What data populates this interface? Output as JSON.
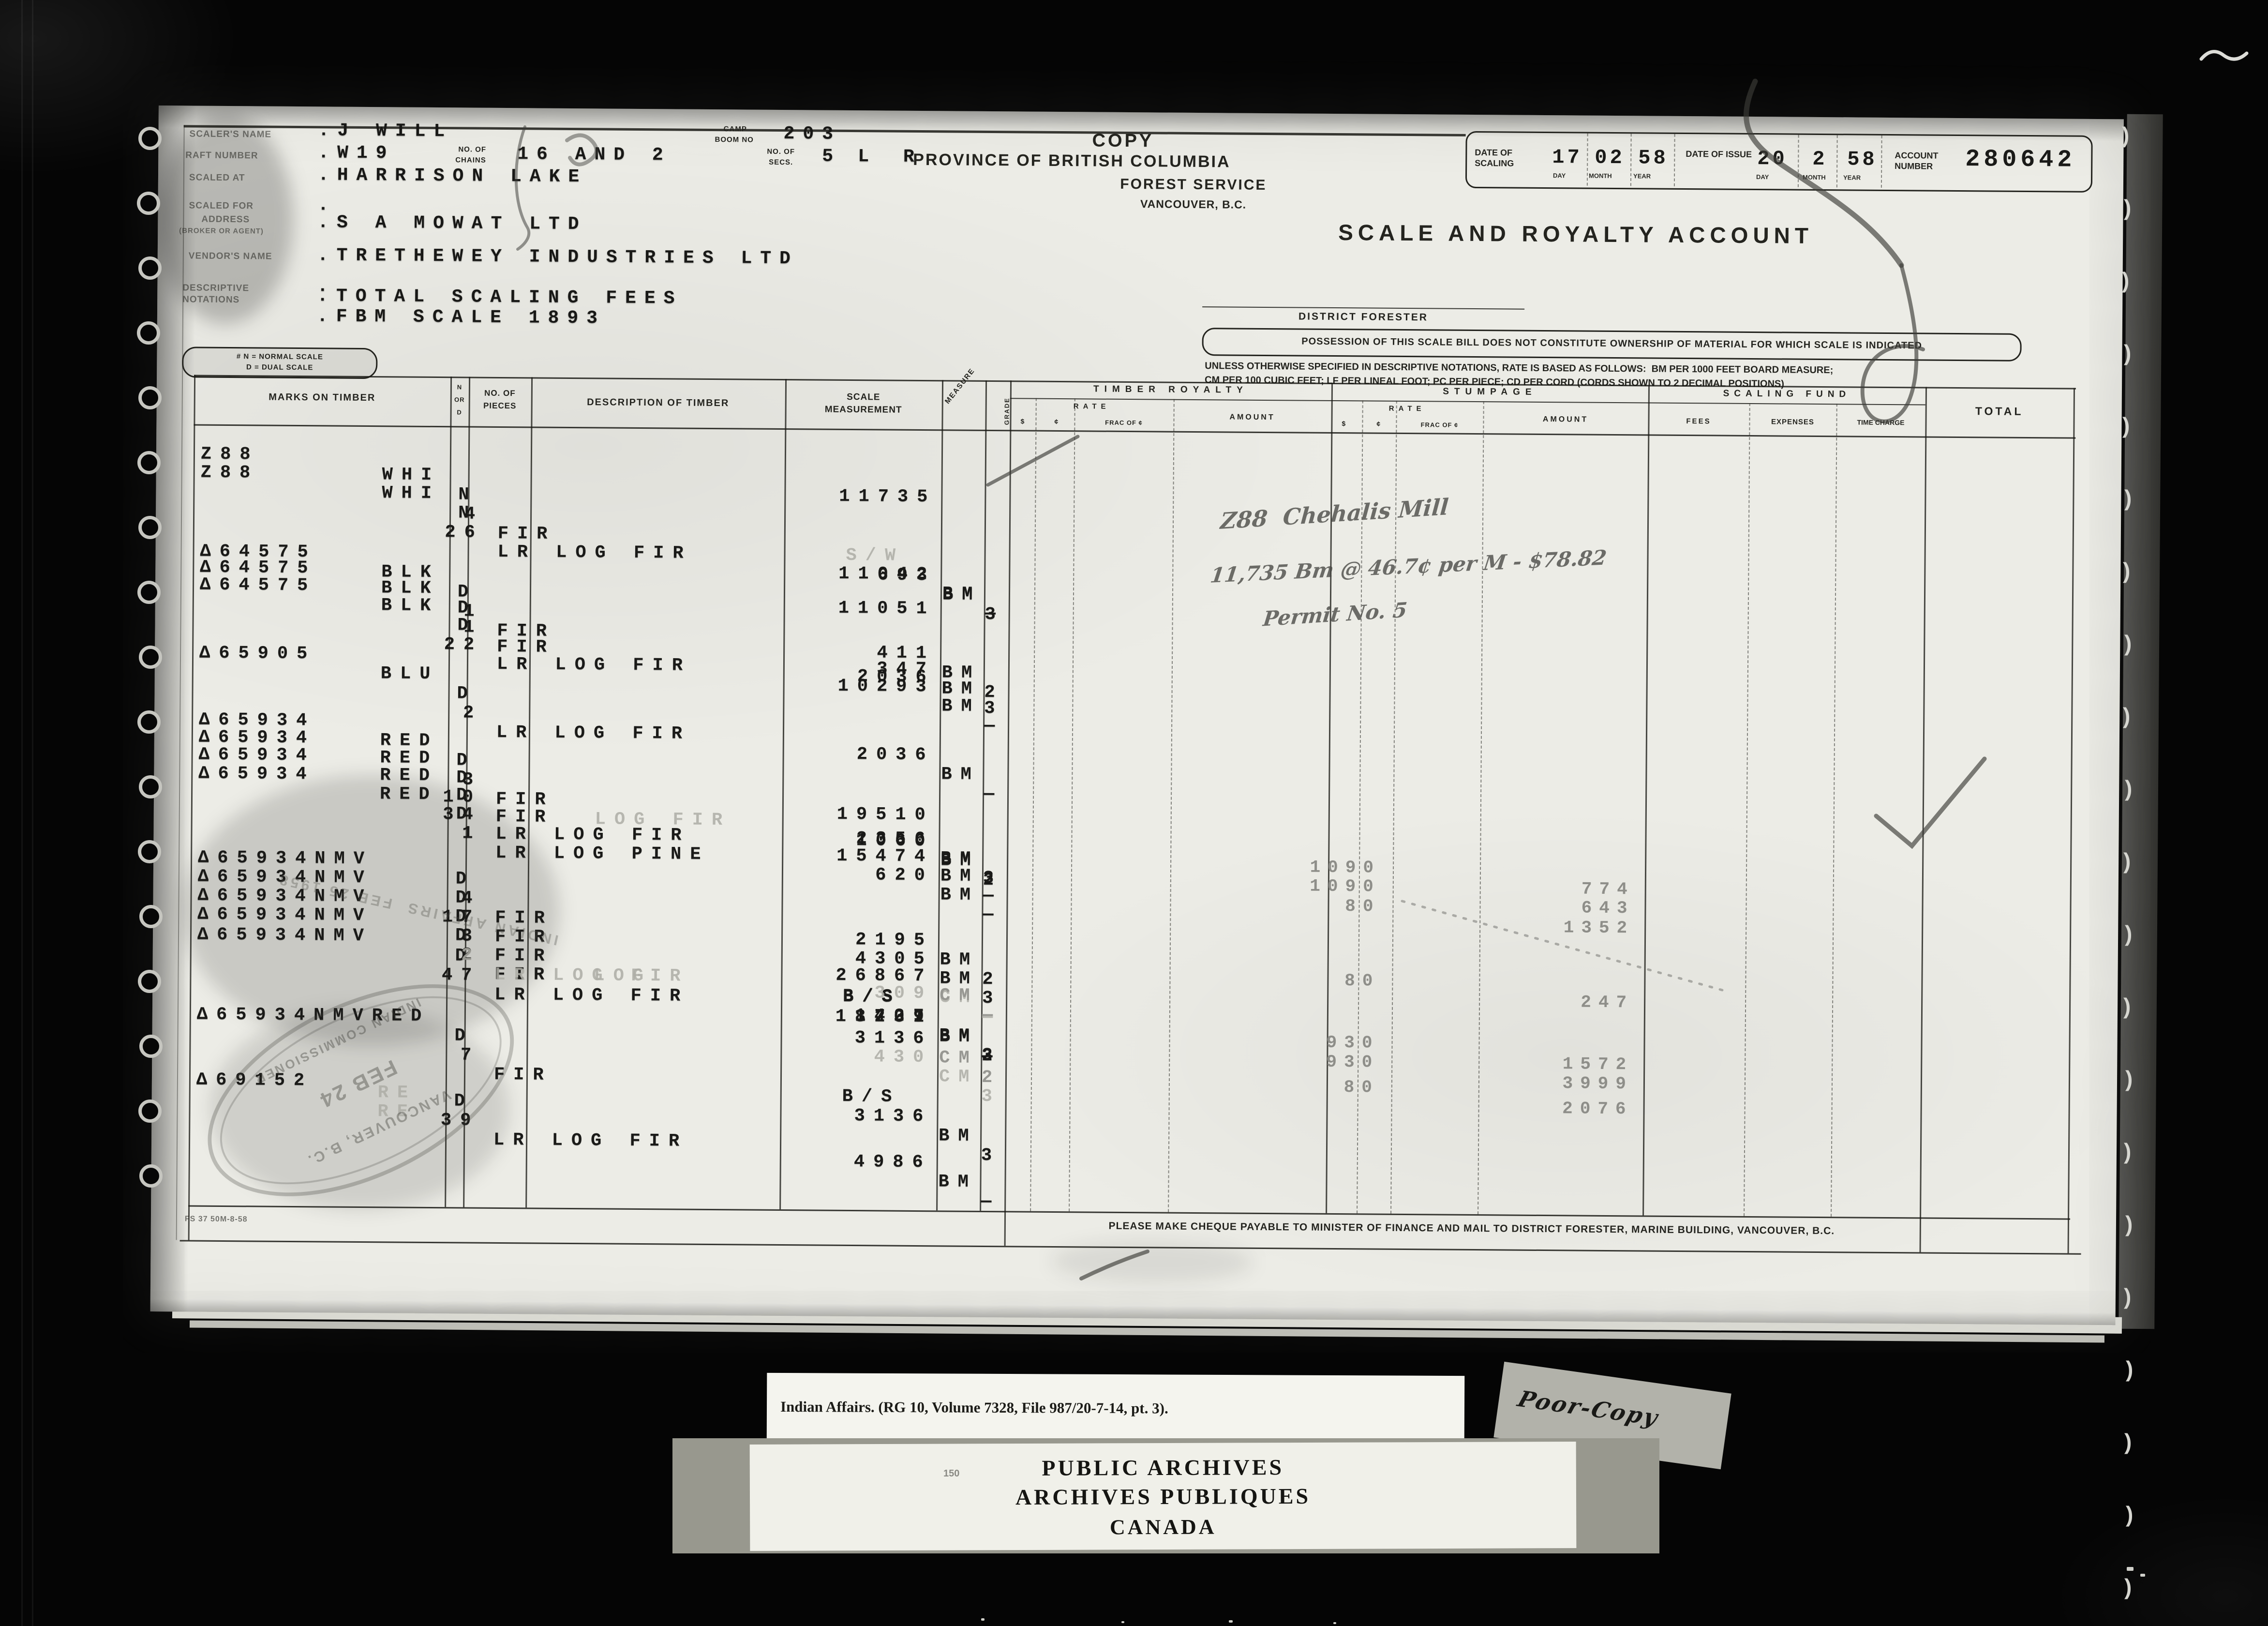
{
  "header": {
    "copy_label": "COPY",
    "province_prefix": "L R",
    "province": "PROVINCE OF BRITISH COLUMBIA",
    "service": "FOREST SERVICE",
    "city": "VANCOUVER, B.C.",
    "account_title": "SCALE AND ROYALTY ACCOUNT",
    "district_forester": "DISTRICT FORESTER",
    "possession_note": "POSSESSION OF THIS SCALE BILL DOES NOT CONSTITUTE OWNERSHIP OF MATERIAL FOR WHICH SCALE IS INDICATED",
    "rate_note_1": "UNLESS OTHERWISE SPECIFIED IN DESCRIPTIVE NOTATIONS, RATE IS BASED AS FOLLOWS:  BM PER 1000 FEET BOARD MEASURE;",
    "rate_note_2": "CM PER 100 CUBIC FEET; LF PER LINEAL FOOT; PC PER PIECE; CD PER CORD (CORDS SHOWN TO 2 DECIMAL POSITIONS)",
    "legend_1": "# N = NORMAL SCALE",
    "legend_2": "D = DUAL SCALE",
    "fields": {
      "scalers_name_label": "SCALER'S NAME",
      "scalers_name": ".J WILL",
      "camp_label_1": "CAMP",
      "camp_label_2": "BOOM NO",
      "camp_boom": "203",
      "raft_label": "RAFT NUMBER",
      "raft": ".W19",
      "chains_label_1": "NO. OF",
      "chains_label_2": "CHAINS",
      "chains": "16 AND 2",
      "secs_label_1": "NO. OF",
      "secs_label_2": "SECS.",
      "secs": "5",
      "scaled_at_label": "SCALED AT",
      "scaled_at": ".HARRISON LAKE",
      "scaled_for_label": "SCALED FOR",
      "scaled_for": ".",
      "address_label_1": "ADDRESS",
      "address_label_2": "(BROKER OR AGENT)",
      "address": ".S A MOWAT LTD",
      "vendor_label": "VENDOR'S NAME",
      "vendor": ".TRETHEWEY INDUSTRIES LTD",
      "blank_value": ".",
      "descriptive_label_1": "DESCRIPTIVE",
      "descriptive_label_2": "NOTATIONS",
      "descriptive_1": ".TOTAL SCALING FEES",
      "descriptive_2": ".FBM SCALE 1893"
    },
    "dates": {
      "scaling_label": "DATE OF SCALING",
      "scaling_day": "17",
      "scaling_month": "02",
      "scaling_year": "58",
      "issue_label": "DATE OF ISSUE",
      "issue_day": "20",
      "issue_month": "2",
      "issue_year": "58",
      "day_label": "DAY",
      "month_label": "MONTH",
      "year_label": "YEAR",
      "account_label": "ACCOUNT NUMBER",
      "account_number": "280642"
    }
  },
  "table": {
    "columns": {
      "marks": "MARKS ON TIMBER",
      "nd_1": "N",
      "nd_2": "OR",
      "nd_3": "D",
      "pieces_1": "NO. OF",
      "pieces_2": "PIECES",
      "description": "DESCRIPTION OF TIMBER",
      "scale_1": "SCALE",
      "scale_2": "MEASUREMENT",
      "measure": "MEASURE",
      "grade": "GRADE",
      "timber_royalty": "TIMBER ROYALTY",
      "stumpage": "STUMPAGE",
      "scaling_fund": "SCALING FUND",
      "total": "TOTAL",
      "rate": "RATE",
      "amount": "AMOUNT",
      "dollar": "$",
      "cent": "¢",
      "frac": "FRAC OF ¢",
      "fees": "FEES",
      "expenses": "EXPENSES",
      "time_charge": "TIME CHARGE"
    },
    "rows": [
      {
        "mark": "Z88",
        "brand": "WHI",
        "nd": "N",
        "pieces": "4",
        "desc": "FIR",
        "note": "S/W",
        "scale": "693",
        "meas": "BM",
        "grade": "3"
      },
      {
        "mark": "Z88",
        "brand": "WHI",
        "nd": "N",
        "pieces": "26",
        "desc": "LR LOG FIR",
        "scale": "11042",
        "meas": "BM",
        "grade": "—"
      },
      {
        "scale": "11735"
      },
      {
        "mark": "Δ64575",
        "brand": "BLK",
        "nd": "D",
        "pieces": "1",
        "desc": "FIR",
        "scale": "411",
        "meas": "BM",
        "grade": "2"
      },
      {
        "mark": "Δ64575",
        "brand": "BLK",
        "nd": "D",
        "pieces": "1",
        "desc": "FIR",
        "scale": "347",
        "meas": "BM",
        "grade": "3"
      },
      {
        "mark": "Δ64575",
        "brand": "BLK",
        "nd": "D",
        "pieces": "22",
        "desc": "LR LOG FIR",
        "scale": "10293",
        "meas": "BM",
        "grade": "—"
      },
      {
        "scale": "11051"
      },
      {
        "mark": "Δ65905",
        "brand": "BLU",
        "nd": "D",
        "pieces": "2",
        "desc": "LR LOG FIR",
        "scale": "2036",
        "meas": "BM",
        "grade": "—"
      },
      {
        "scale": "2036"
      },
      {
        "mark": "Δ65934",
        "brand": "RED",
        "nd": "D",
        "pieces": "3",
        "desc": "FIR",
        "ghost": "LOG FIR",
        "scale": "1060",
        "meas": "BM",
        "grade": "2"
      },
      {
        "mark": "Δ65934",
        "brand": "RED",
        "nd": "D",
        "pieces": "10",
        "desc": "FIR",
        "scale": "2356",
        "meas": "BM",
        "grade": "3"
      },
      {
        "mark": "Δ65934",
        "brand": "RED",
        "nd": "D",
        "pieces": "34",
        "desc": "LR LOG FIR",
        "scale": "15474",
        "meas": "BM",
        "grade": "—"
      },
      {
        "mark": "Δ65934",
        "brand": "RED",
        "nd": "D",
        "pieces": "1",
        "desc": "LR LOG PINE",
        "scale": "620",
        "meas": "BM",
        "grade": "—"
      },
      {
        "scale": "19510"
      },
      {
        "mark": "Δ65934NMV",
        "nd": "D",
        "pieces": "4",
        "desc": "FIR",
        "scale": "2195",
        "meas": "BM",
        "grade": "2"
      },
      {
        "mark": "Δ65934NMV",
        "nd": "D",
        "pieces": "17",
        "desc": "FIR",
        "scale": "4305",
        "meas": "BM",
        "grade": "3"
      },
      {
        "mark": "Δ65934NMV",
        "nd": "D",
        "pieces": "3",
        "desc": "FIR",
        "ghost": "LOG",
        "note": "B/S",
        "scale": "1709",
        "meas": "BM",
        "grade": "2"
      },
      {
        "mark": "Δ65934NMV",
        "nd": "D",
        "pieces": "2",
        "desc": "FIR",
        "note": "B/S",
        "scale": "1427",
        "meas": "BM",
        "grade": "3"
      },
      {
        "mark": "Δ65934NMV",
        "nd": "D",
        "pieces": "47",
        "desc": "LR LOG FIR",
        "scale": "18231",
        "meas": "BM",
        "grade": "—"
      },
      {
        "pieces": "2",
        "desc": "LR LOG FIR",
        "meas": "CM",
        "grade": "—"
      },
      {
        "scale": "26867",
        "meas": "CM",
        "grade": "—"
      },
      {
        "scale": "309"
      },
      {
        "mark": "Δ65934NMVRED",
        "nd": "D",
        "pieces": "7",
        "desc": "FIR",
        "note": "B/S",
        "scale": "3136",
        "meas": "BM",
        "grade": "3"
      },
      {
        "scale": "3136",
        "meas": "CM",
        "grade": "2"
      },
      {
        "scale": "430",
        "meas": "CM",
        "grade": "3"
      },
      {
        "mark": "Δ69152",
        "nd": "D",
        "pieces": "39",
        "desc": "LR LOG FIR",
        "scale": "4986",
        "meas": "BM",
        "grade": "—"
      }
    ],
    "ghost_cells": {
      "re_1": "RE",
      "re_2": "RE"
    },
    "stumpage_entries": [
      {
        "rate": "1090",
        "amount": "774"
      },
      {
        "rate": "1090",
        "amount": "643"
      },
      {
        "rate": "80",
        "amount": "1352"
      },
      {
        "rate": "80",
        "amount": "247"
      },
      {
        "rate": "930",
        "amount": "1572"
      },
      {
        "rate": "930",
        "amount": "3999"
      },
      {
        "rate": "80",
        "amount": "2076"
      }
    ],
    "footer_note": "PLEASE MAKE CHEQUE PAYABLE TO MINISTER OF FINANCE AND MAIL TO DISTRICT FORESTER, MARINE BUILDING, VANCOUVER, B.C.",
    "form_number": "FS 37 50M-8-58"
  },
  "annotations": {
    "pencil_line_1": "Z88  Chehalis Mill",
    "pencil_line_2": "11,735 Bm @ 46.7¢ per M - $78.82",
    "pencil_line_3": "Permit No. 5",
    "stamp_top": "INDIAN COMMISSIONER",
    "stamp_date": "FEB 24",
    "stamp_city": "VANCOUVER, B.C.",
    "ghost_stamp": "INDIAN AFFAIRS  FEB 25 1958"
  },
  "film": {
    "caption": "Indian Affairs. (RG 10, Volume 7328, File 987/20-7-14, pt. 3).",
    "poor_copy": "Poor-Copy",
    "archives_1": "PUBLIC ARCHIVES",
    "archives_2": "ARCHIVES PUBLIQUES",
    "archives_3": "CANADA",
    "tiny_mark": "150"
  }
}
